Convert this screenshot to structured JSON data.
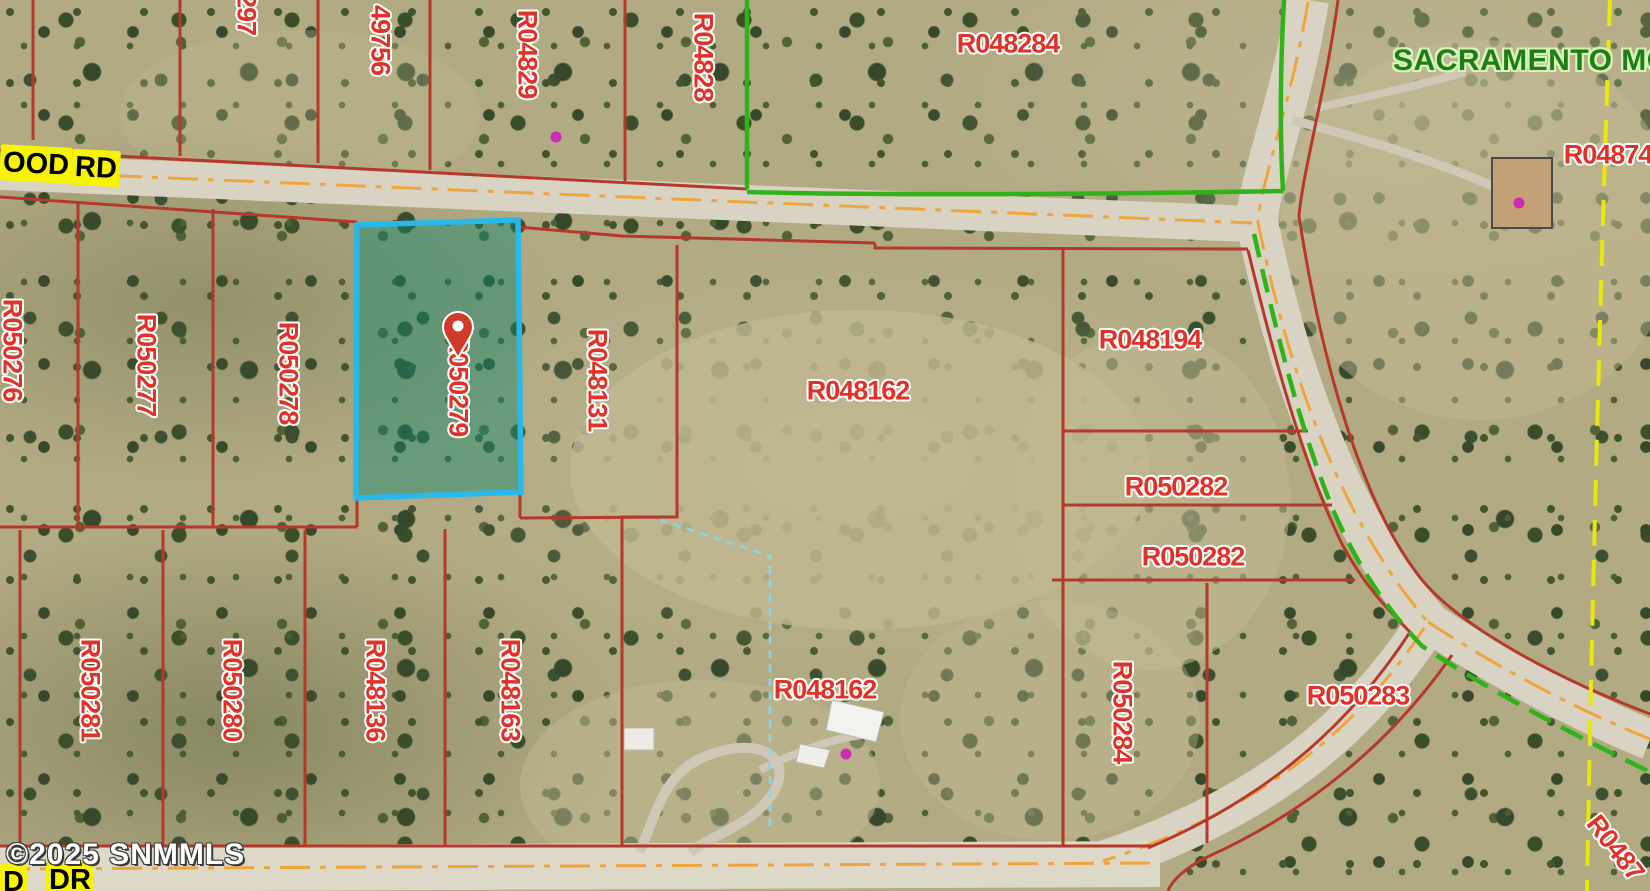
{
  "map": {
    "watermark": "©2025 SNMMLS",
    "colors": {
      "highlight_border": "#29b8ea",
      "selected_fill_tint": "rgba(15,135,110,0.45)",
      "parcel_line": "#b5392b",
      "parcel_label": "#e03228",
      "boundary_green": "#2fb318",
      "boundary_yellow": "#e8e80a",
      "road_centerline_orange": "#f0a43c",
      "poi_dot_magenta": "#cc2bb4"
    },
    "selected_parcel": {
      "id": "R050279"
    },
    "area_label": "SACRAMENTO MOU",
    "road_labels": [
      {
        "text": "OOD"
      },
      {
        "text": "RD"
      },
      {
        "text": "D"
      },
      {
        "text": "DR"
      }
    ],
    "parcel_labels_horizontal": [
      {
        "text": "R048284"
      },
      {
        "text": "R04874"
      },
      {
        "text": "R048194"
      },
      {
        "text": "R048162"
      },
      {
        "text": "R050282"
      },
      {
        "text": "R050282"
      },
      {
        "text": "R048162"
      },
      {
        "text": "R050283"
      }
    ],
    "parcel_labels_vertical": [
      {
        "text": "297"
      },
      {
        "text": "49756"
      },
      {
        "text": "R04829"
      },
      {
        "text": "R04828"
      },
      {
        "text": "R050276"
      },
      {
        "text": "R050277"
      },
      {
        "text": "R050278"
      },
      {
        "text": "R050279"
      },
      {
        "text": "R048131"
      },
      {
        "text": "R050281"
      },
      {
        "text": "R050280"
      },
      {
        "text": "R048136"
      },
      {
        "text": "R048163"
      },
      {
        "text": "R050284"
      }
    ],
    "parcel_label_diagonal": {
      "text": "R0487"
    }
  }
}
